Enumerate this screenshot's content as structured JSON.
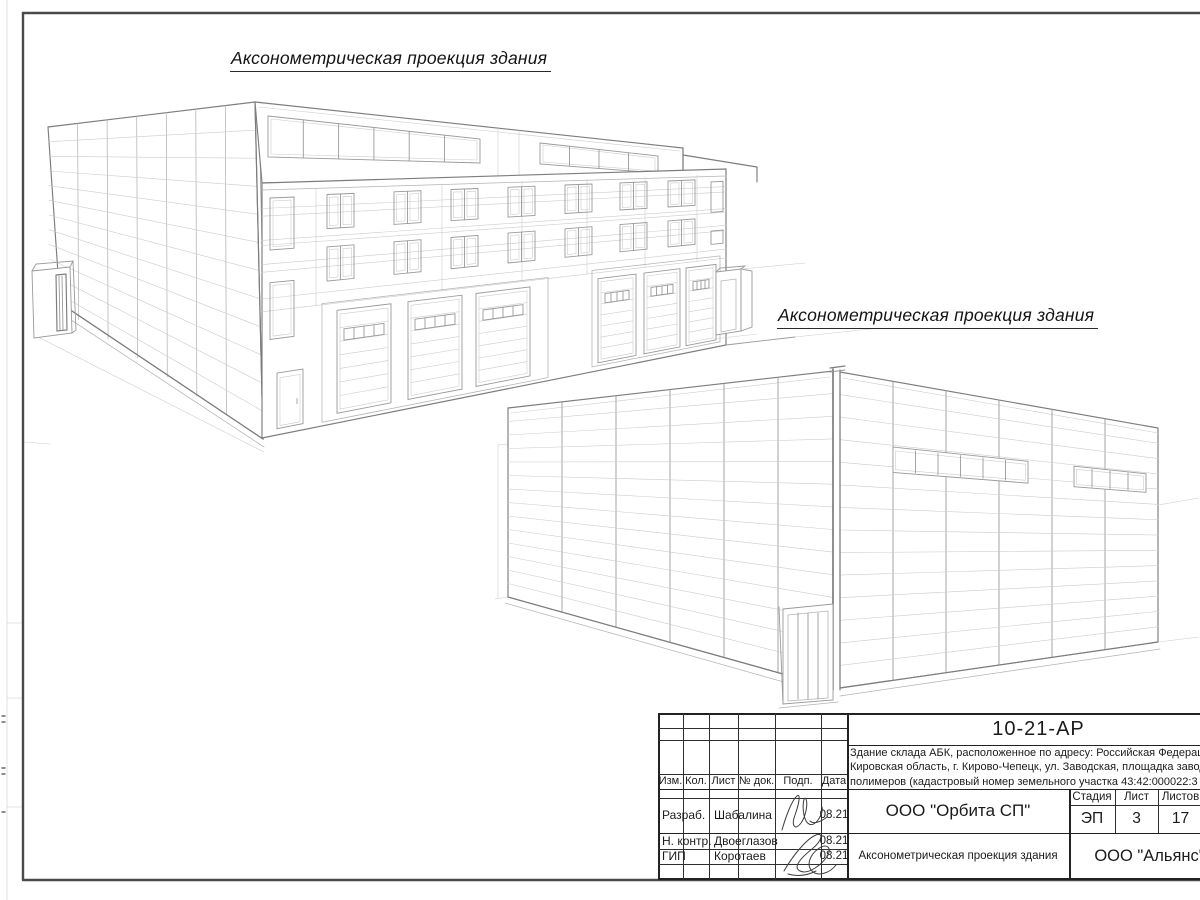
{
  "sheet": {
    "caption_left": "Аксонометрическая проекция здания",
    "caption_right": "Аксонометрическая проекция здания"
  },
  "title_block": {
    "doc_number": "10-21-АР",
    "description_lines": [
      "Здание склада АБК, расположенное по адресу: Российская Федерация,",
      "Кировская область, г. Кирово-Чепецк, ул. Заводская, площадка завода",
      "полимеров (кадастровый номер земельного участка 43:42:000022:3"
    ],
    "header_cells": [
      "Изм.",
      "Кол.",
      "Лист",
      "№ док.",
      "Подп.",
      "Дата"
    ],
    "rows": [
      {
        "role": "Разраб.",
        "name": "Шабалина",
        "date": "08.21"
      },
      {
        "role": "Н. контр.",
        "name": "Двоеглазов",
        "date": "08.21"
      },
      {
        "role": "ГИП",
        "name": "Коротаев",
        "date": "08.21"
      }
    ],
    "org": "ООО \"Орбита СП\"",
    "sheet_title": "Аксонометрическая проекция здания",
    "company": "ООО \"Альянс\"",
    "stage_headers": [
      "Стадия",
      "Лист",
      "Листов"
    ],
    "stage_values": [
      "ЭП",
      "3",
      "17"
    ]
  }
}
